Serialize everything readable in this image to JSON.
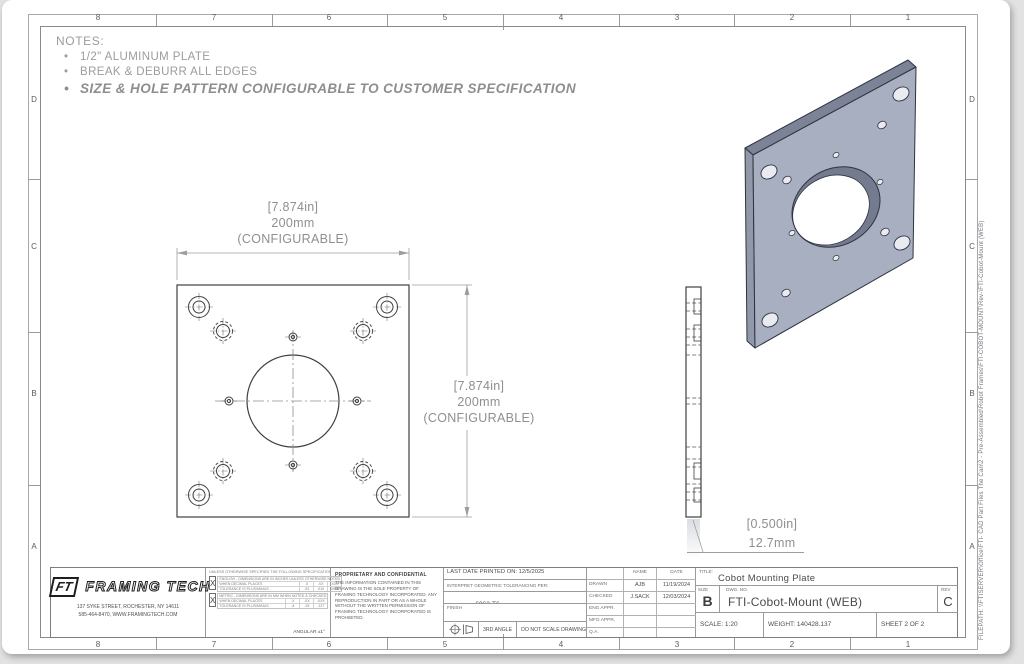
{
  "sheet": {
    "zones_top": [
      "8",
      "7",
      "6",
      "5",
      "4",
      "3",
      "2",
      "1"
    ],
    "zones_bottom": [
      "8",
      "7",
      "6",
      "5",
      "4",
      "3",
      "2",
      "1"
    ],
    "zones_left": [
      "D",
      "C",
      "B",
      "A"
    ],
    "zones_right": [
      "D",
      "C",
      "B",
      "A"
    ],
    "filepath": "FILEPATH: \\\\FTISERVER\\Office\\FTI- CAD Part Files The Can\\2 - Pre-Assembled\\Robot Frames\\FTI-COBOT-MOUNT\\Rev-\\FTI-Cobot-Mount (WEB)"
  },
  "notes": {
    "heading": "NOTES:",
    "items": [
      "1/2\" ALUMINUM PLATE",
      "BREAK & DEBURR ALL EDGES",
      "SIZE & HOLE PATTERN CONFIGURABLE TO CUSTOMER SPECIFICATION"
    ]
  },
  "dimensions": {
    "width": {
      "line1": "[7.874in]",
      "line2": "200mm",
      "line3": "(CONFIGURABLE)"
    },
    "height": {
      "line1": "[7.874in]",
      "line2": "200mm",
      "line3": "(CONFIGURABLE)"
    },
    "thickness": {
      "line1": "[0.500in]",
      "line2": "12.7mm"
    }
  },
  "title_block": {
    "company": {
      "logo_initials": "FT",
      "logo_name": "FRAMING TECH",
      "address_line1": "137 SYKE STREET, ROCHESTER, NY 14611",
      "address_line2": "585-464-8470, WWW.FRAMINGTECH.COM"
    },
    "tolerances": {
      "header": "UNLESS OTHERWISE SPECIFIED THE FOLLOWING SPECIFICATIONS APPLY",
      "rows": [
        {
          "check": "X",
          "line1": "ENGLISH - DIMENSIONS ARE IN INCHES UNLESS OTHERWISE NOTED",
          "line2": "WHEN DECIMAL PLACES",
          "cols": [
            ".X",
            ".XX",
            ".XXX"
          ],
          "line3": "TOLERANCE IS PLUS/MINUS",
          "vals": [
            ".03",
            ".010",
            ".0050"
          ]
        },
        {
          "check": "X",
          "line1": "METRIC - DIMENSIONS ARE IN MM WHEN NOTED & CHECKED",
          "line2": "WHEN DECIMAL PLACES",
          "cols": [
            ".X",
            ".XX",
            ".XXX"
          ],
          "line3": "TOLERANCE IS PLUS/MINUS",
          "vals": [
            ".8",
            ".25",
            ".127"
          ]
        }
      ],
      "angular": "ANGULAR ±1°"
    },
    "proprietary": {
      "heading": "PROPRIETARY AND CONFIDENTIAL",
      "body": "THE INFORMATION CONTAINED IN THIS DRAWING IS THE SOLE PROPERTY OF FRAMING TECHNOLOGY INCORPORATED.  ANY REPRODUCTION IN PART OR AS A WHOLE WITHOUT THE WRITTEN PERMISSION OF FRAMING TECHNOLOGY INCORPORATED IS PROHIBITED.",
      "check_mark": "X"
    },
    "printed": "LAST DATE PRINTED ON: 12/5/2025",
    "interpret": "INTERPRET GEOMETRIC TOLERANCING PER:",
    "material_label": "MATERIAL:",
    "material_value": "6063-T6",
    "finish_label": "FINISH",
    "third_angle": "3RD ANGLE",
    "do_not_scale": "DO NOT SCALE DRAWING",
    "approvals": {
      "name_header": "NAME",
      "date_header": "DATE",
      "rows": [
        {
          "label": "DRAWN",
          "name": "AJB",
          "date": "11/19/2024"
        },
        {
          "label": "CHECKED",
          "name": "J.SACK",
          "date": "12/03/2024"
        },
        {
          "label": "ENG APPR.",
          "name": "",
          "date": ""
        },
        {
          "label": "MFG APPR.",
          "name": "",
          "date": ""
        },
        {
          "label": "Q.A.",
          "name": "",
          "date": ""
        }
      ]
    },
    "title_label": "TITLE:",
    "title": "Cobot Mounting Plate",
    "size_label": "SIZE",
    "size": "B",
    "dwg_label": "DWG.  NO.",
    "dwg_no": "FTI-Cobot-Mount (WEB)",
    "rev_label": "REV",
    "rev": "C",
    "scale": "SCALE: 1:20",
    "weight": "WEIGHT: 140428.137",
    "sheet_num": "SHEET 2 OF 2"
  }
}
